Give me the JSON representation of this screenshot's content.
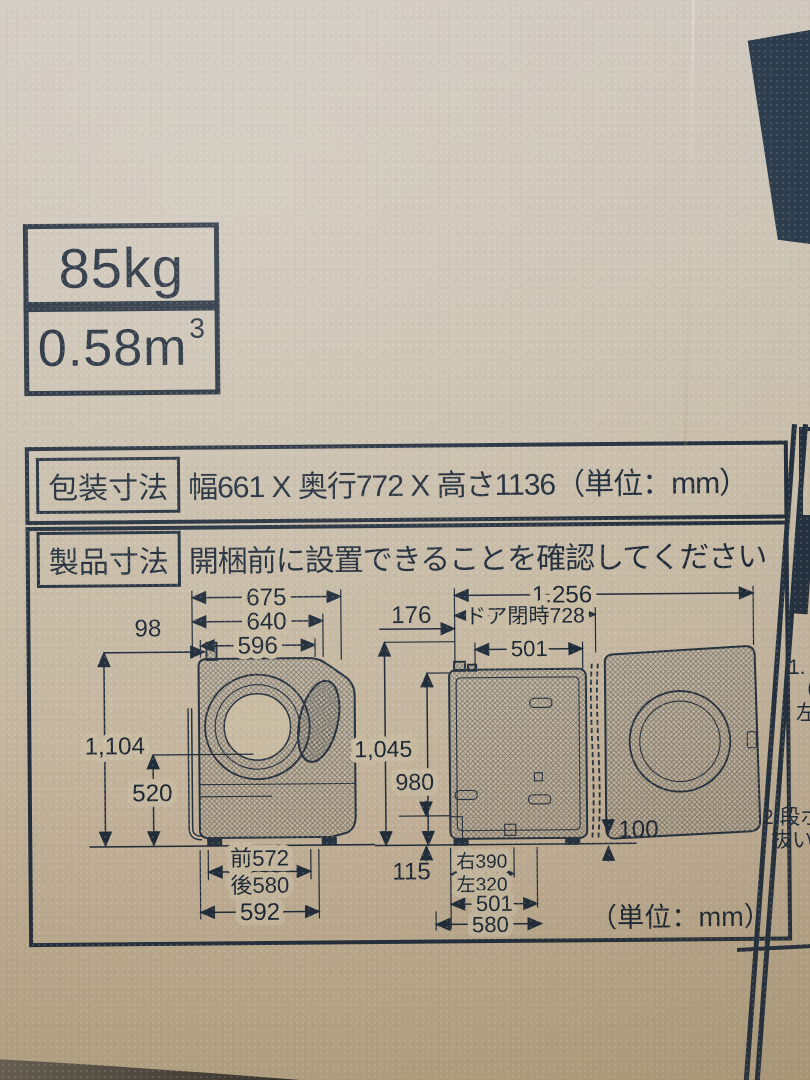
{
  "colors": {
    "ink": "#202c3a",
    "cardboard": "#c6b89f",
    "edge_panel_dark": "#243140"
  },
  "stickers": {
    "weight": "85kg",
    "volume_value": "0.58m",
    "volume_exponent": "3"
  },
  "packaging": {
    "label": "包装寸法",
    "value": "幅661 X 奥行772 X 高さ1136（単位：mm）"
  },
  "product": {
    "label": "製品寸法",
    "headline": "開梱前に設置できることを確認してください",
    "unit_note": "（単位：mm）"
  },
  "side_view": {
    "width_total": "675",
    "width_mid": "640",
    "width_body": "596",
    "inlet_offset": "98",
    "height_total": "1,104",
    "height_lower": "520",
    "depth_front": "前572",
    "depth_rear": "後580",
    "depth_total": "592"
  },
  "open_view": {
    "width_door_open": "1,256",
    "rear_offset": "176",
    "width_door_closed": "ドア閉時728",
    "width_body_top": "501",
    "height_total": "1,045",
    "height_body": "980",
    "height_base": "115",
    "door_floor_gap": "100",
    "leg_right": "右390",
    "leg_left": "左320",
    "width_bottom_inner": "501",
    "width_bottom_outer": "580"
  },
  "edge_panel": {
    "fragment_1": "1.",
    "fragment_2": "（",
    "fragment_3": "左",
    "fragment_4": "2.段ボー",
    "fragment_5": "抜い"
  }
}
